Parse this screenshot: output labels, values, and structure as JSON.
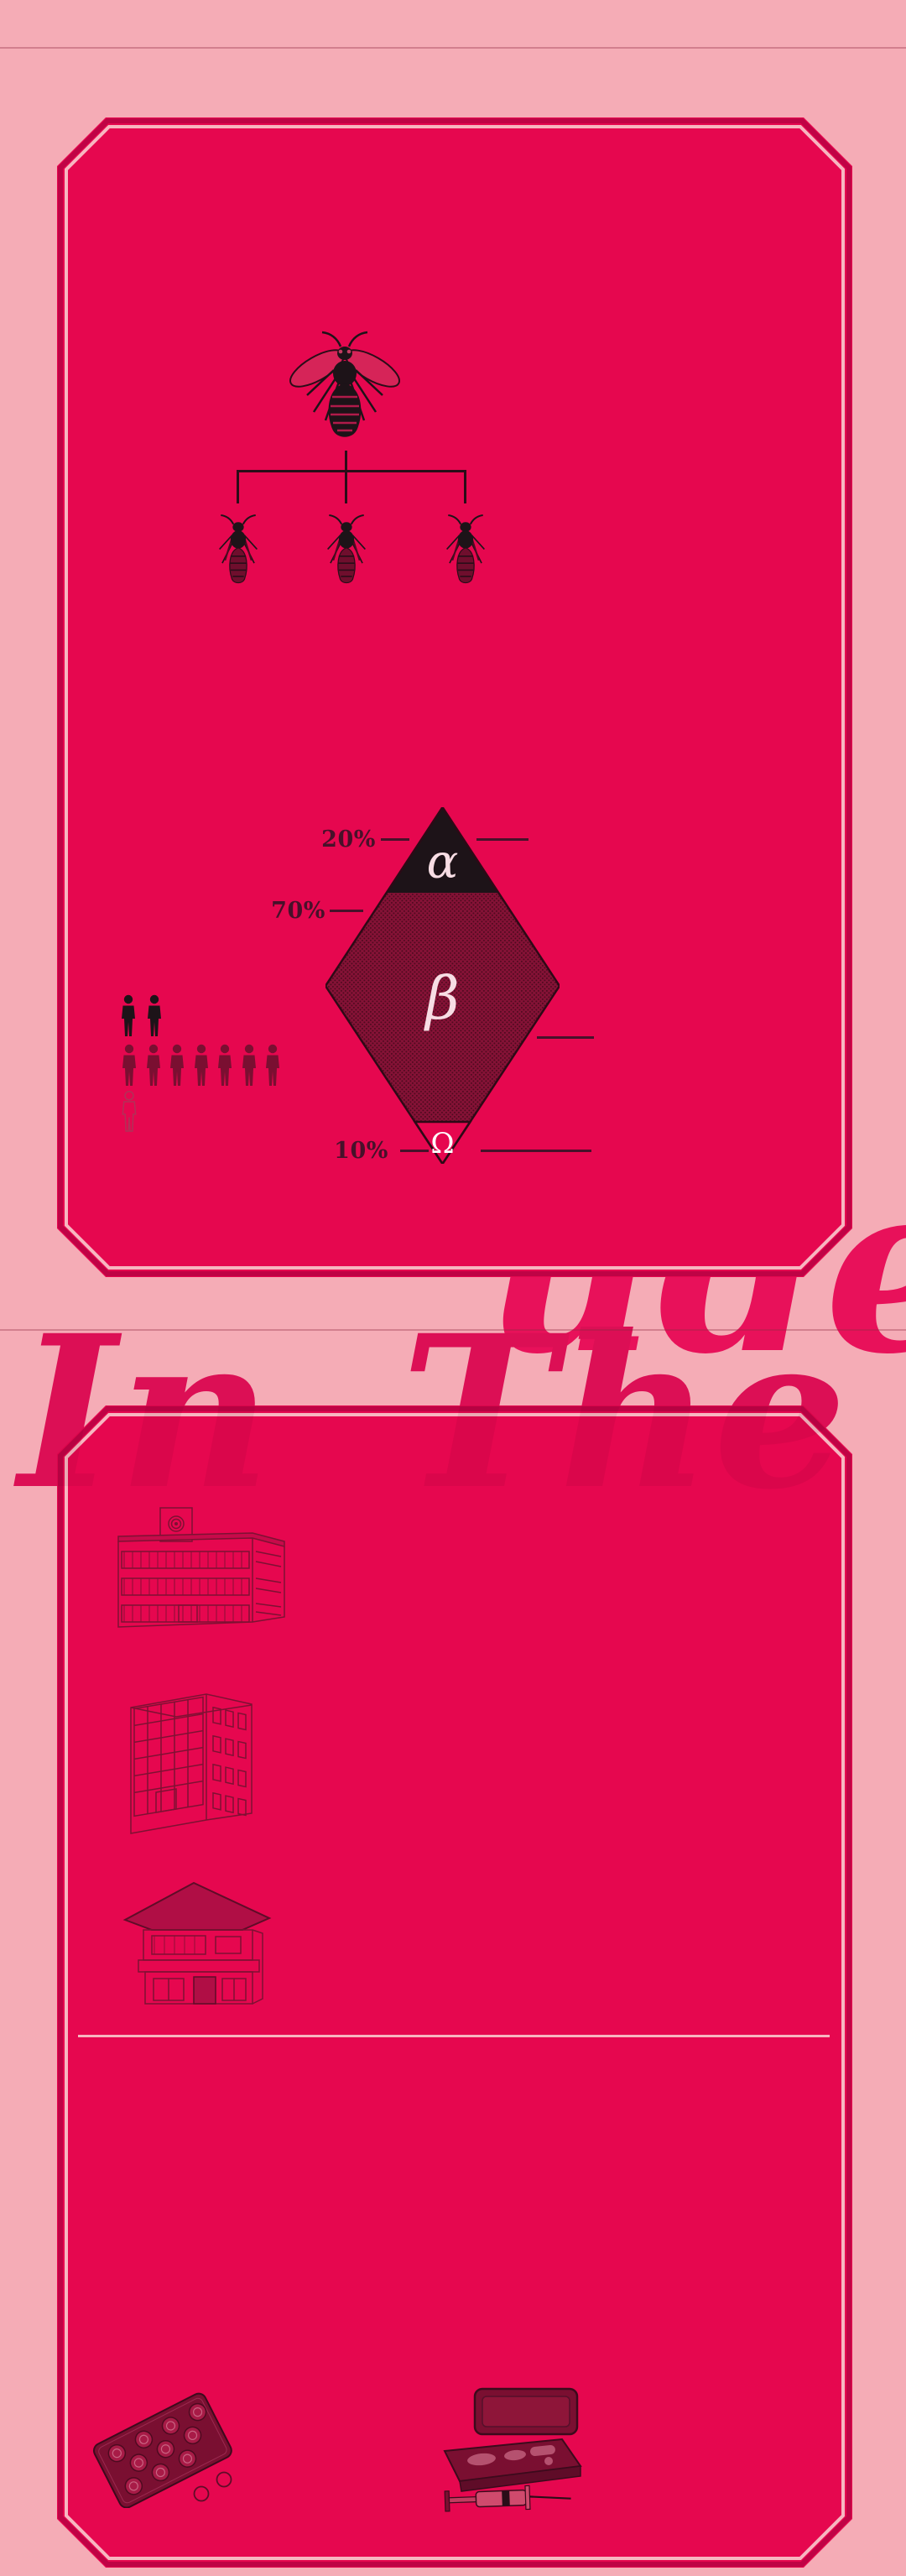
{
  "colors": {
    "background": "#f5acb6",
    "panel": "#e6074f",
    "panel_rim": "#bf0345",
    "panel_inner_line": "#f7b6c0",
    "near_black": "#1d1318",
    "dark_maroon": "#7a0f31",
    "label_text": "#47112a",
    "script_text": "#e8115a",
    "white": "#ffffff"
  },
  "overlay": {
    "top_fragment": "ude",
    "bottom_fragment": "In The"
  },
  "panel1": {
    "family_tree": {
      "parent_icon": "queen-wasp-icon",
      "child_icon": "wasp-icon",
      "children_count": 3
    },
    "diamond": {
      "segments": [
        {
          "label": "α",
          "value": "20%",
          "color": "#1d1318"
        },
        {
          "label": "β",
          "value": "70%",
          "color": "#851236"
        },
        {
          "label": "Ω",
          "value": "10%",
          "color": "#e6074f"
        }
      ]
    },
    "pictogram": {
      "total": 10,
      "rows": [
        {
          "count": 2,
          "style": "solid-black"
        },
        {
          "count": 7,
          "style": "solid-maroon"
        },
        {
          "count": 1,
          "style": "outline"
        }
      ]
    }
  },
  "panel2": {
    "buildings": [
      {
        "icon": "school-clock-tower-building-icon"
      },
      {
        "icon": "office-block-building-icon"
      },
      {
        "icon": "two-story-house-icon"
      }
    ],
    "objects": [
      {
        "icon": "pill-blister-pack-icon"
      },
      {
        "icon": "syringe-case-icon"
      }
    ]
  },
  "chart_data": {
    "type": "pie",
    "variant": "diamond-funnel",
    "title": "",
    "categories": [
      "α",
      "β",
      "Ω"
    ],
    "values": [
      20,
      70,
      10
    ],
    "unit": "%",
    "annotations": [
      "20%",
      "70%",
      "10%"
    ],
    "legend_position": "left-leader-lines"
  }
}
